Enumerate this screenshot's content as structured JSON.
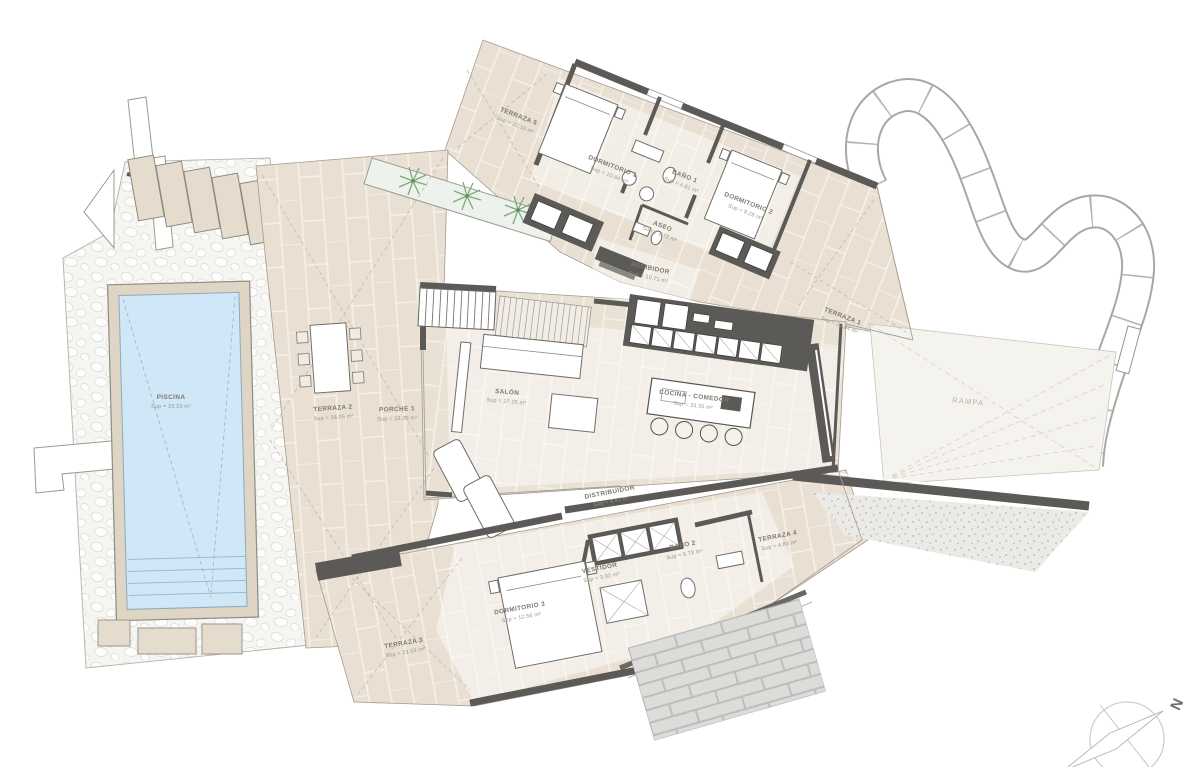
{
  "plan_title": "villa-floor-plan",
  "rooms": {
    "piscina": {
      "label": "PISCINA",
      "area": "Sup = 33.23 m²"
    },
    "terraza_5": {
      "label": "TERRAZA 5",
      "area": "Sup = 22.10 m²"
    },
    "dormitorio_1": {
      "label": "DORMITORIO 1",
      "area": "Sup = 10.84 m²"
    },
    "bano_1": {
      "label": "BAÑO 1",
      "area": "Sup = 4.81 m²"
    },
    "dormitorio_2": {
      "label": "DORMITORIO 2",
      "area": "Sup = 9.28 m²"
    },
    "aseo": {
      "label": "ASEO",
      "area": "Sup = 1.72 m²"
    },
    "recibidor": {
      "label": "RECIBIDOR",
      "area": "Sup = 10.71 m²"
    },
    "terraza_1": {
      "label": "TERRAZA 1",
      "area": "Sup = 23.84 m²"
    },
    "terraza_2": {
      "label": "TERRAZA 2",
      "area": "Sup = 58.05 m²"
    },
    "porche_1": {
      "label": "PORCHE 1",
      "area": "Sup = 10.20 m²"
    },
    "salon": {
      "label": "SALÓN",
      "area": "Sup = 27.25 m²"
    },
    "cocina_comedor": {
      "label": "COCINA - COMEDOR",
      "area": "Sup = 33.35 m²"
    },
    "distribuidor": {
      "label": "DISTRIBUIDOR",
      "area": "Sup = 4.41 m²"
    },
    "vestidor": {
      "label": "VESTIDOR",
      "area": "Sup = 3.92 m²"
    },
    "bano_2": {
      "label": "BAÑO 2",
      "area": "Sup = 5.73 m²"
    },
    "terraza_4": {
      "label": "TERRAZA 4",
      "area": "Sup = 4.84 m²"
    },
    "dormitorio_3": {
      "label": "DORMITORIO 3",
      "area": "Sup = 12.56 m²"
    },
    "terraza_3": {
      "label": "TERRAZA 3",
      "area": "Sup = 23.03 m²"
    },
    "rampa": {
      "label": "RAMPA"
    }
  },
  "compass": {
    "north_label": "N"
  },
  "colors": {
    "tile": "#e9e0d3",
    "grout": "#f6f1e8",
    "pool_water": "#cfe7f6",
    "pool_deck": "#ded5c4",
    "wall_dark": "#5c5a57",
    "plant_green": "#7fa87f",
    "brick": "#dcdcda"
  }
}
